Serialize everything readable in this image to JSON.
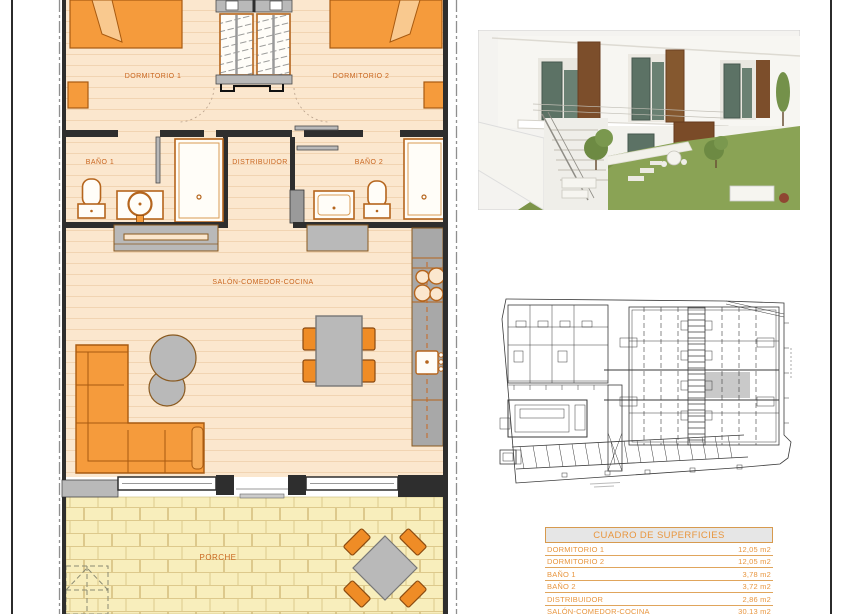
{
  "page": {
    "background": "#ffffff",
    "border_color": "#2b2b2b"
  },
  "floor_plan": {
    "rooms": {
      "dormitorio1": "DORMITORIO 1",
      "dormitorio2": "DORMITORIO 2",
      "bano1": "BAÑO 1",
      "bano2": "BAÑO 2",
      "distribuidor": "DISTRIBUIDOR",
      "salon": "SALÓN-COMEDOR-COCINA",
      "porche": "PORCHE"
    },
    "colors": {
      "furniture_orange": "#f59b3c",
      "chair_orange": "#ef8c26",
      "interior_floor": "#fbe7ce",
      "plank_line": "#f1d4b2",
      "porch_floor": "#f8eebc",
      "brick_line": "#ddc98c",
      "wall_dark": "#2e2e2e",
      "gray_fixture": "#b9b9b9",
      "fixture_outline": "#b5651d",
      "label_text": "#c9661f",
      "boundary_line": "#8f8f8f"
    }
  },
  "exterior_render": {
    "colors": {
      "wall_white": "#f6f5f1",
      "glass_green": "#5c7265",
      "corten_brown": "#7c4e2b",
      "grass_green": "#8aa355"
    }
  },
  "site_plan": {
    "line_color": "#3a3a3a",
    "highlight_unit_color": "#c9c9c9"
  },
  "surfaces_table": {
    "title": "CUADRO DE SUPERFICIES",
    "accent_color": "#e8963f",
    "rows": [
      {
        "label": "DORMITORIO 1",
        "value": "12,05 m2"
      },
      {
        "label": "DORMITORIO 2",
        "value": "12,05 m2"
      },
      {
        "label": "BAÑO 1",
        "value": "3,78 m2"
      },
      {
        "label": "BAÑO 2",
        "value": "3,72 m2"
      },
      {
        "label": "DISTRIBUIDOR",
        "value": "2,86 m2"
      },
      {
        "label": "SALÓN-COMEDOR-COCINA",
        "value": "30,13 m2"
      }
    ]
  }
}
